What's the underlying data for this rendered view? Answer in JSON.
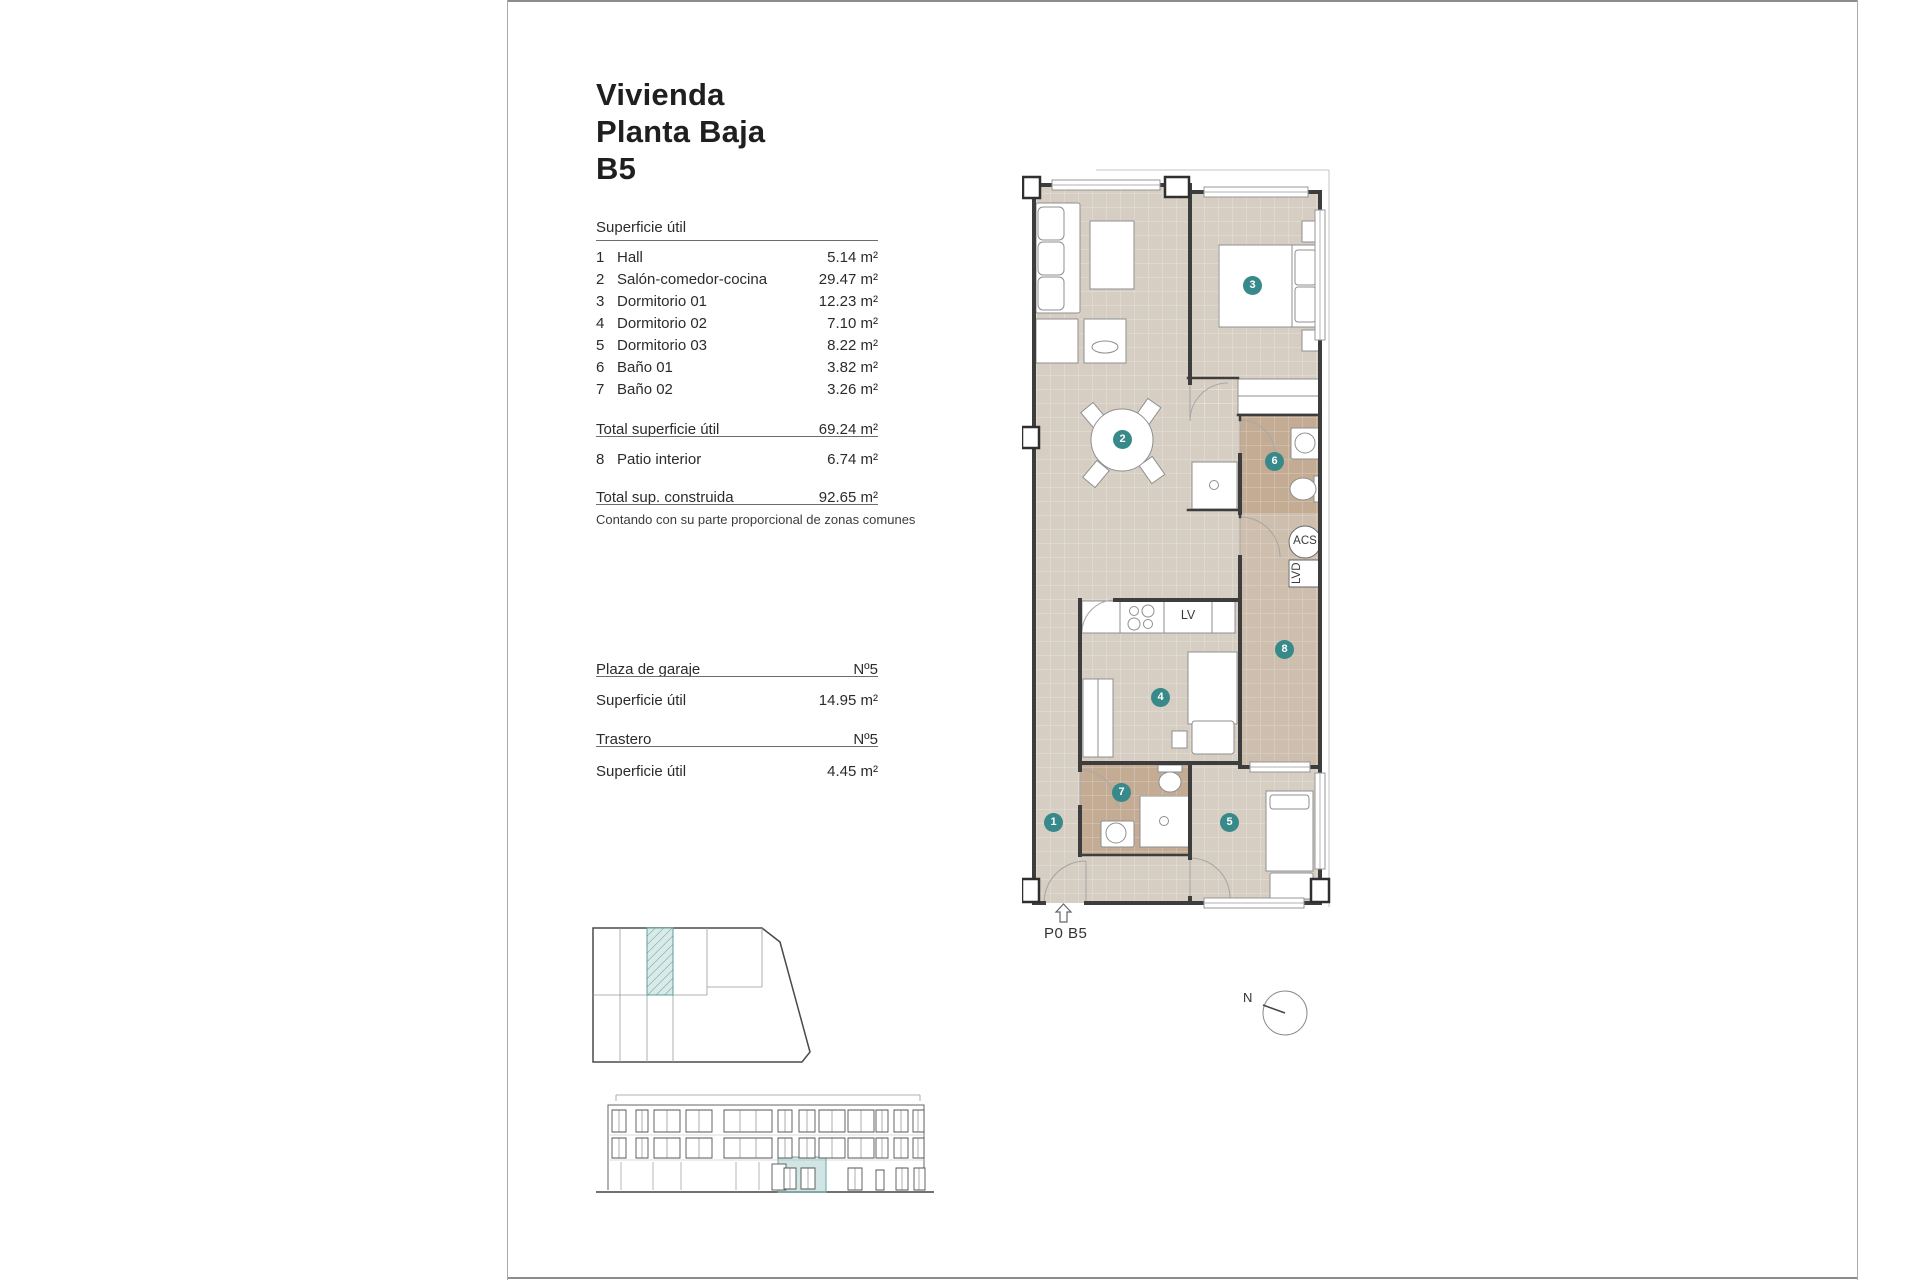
{
  "page": {
    "title_lines": [
      "Vivienda",
      "Planta Baja",
      "B5"
    ]
  },
  "surface_section": {
    "header": "Superficie útil",
    "rows": [
      {
        "num": "1",
        "name": "Hall",
        "area": "5.14 m²"
      },
      {
        "num": "2",
        "name": "Salón-comedor-cocina",
        "area": "29.47 m²"
      },
      {
        "num": "3",
        "name": "Dormitorio 01",
        "area": "12.23 m²"
      },
      {
        "num": "4",
        "name": "Dormitorio 02",
        "area": "7.10 m²"
      },
      {
        "num": "5",
        "name": "Dormitorio 03",
        "area": "8.22 m²"
      },
      {
        "num": "6",
        "name": "Baño 01",
        "area": "3.82 m²"
      },
      {
        "num": "7",
        "name": "Baño 02",
        "area": "3.26 m²"
      }
    ],
    "total_label": "Total superficie útil",
    "total_value": "69.24 m²",
    "patio_row": {
      "num": "8",
      "name": "Patio interior",
      "area": "6.74 m²"
    },
    "constructed_label": "Total sup. construida",
    "constructed_value": "92.65 m²",
    "note": "Contando con su parte proporcional de zonas comunes"
  },
  "garage": {
    "label": "Plaza de garaje",
    "number": "Nº5",
    "area_label": "Superficie útil",
    "area_value": "14.95 m²"
  },
  "storage": {
    "label": "Trastero",
    "number": "Nº5",
    "area_label": "Superficie útil",
    "area_value": "4.45 m²"
  },
  "floor_plan": {
    "rooms": [
      {
        "num": "1"
      },
      {
        "num": "2"
      },
      {
        "num": "3"
      },
      {
        "num": "4"
      },
      {
        "num": "5"
      },
      {
        "num": "6"
      },
      {
        "num": "7"
      },
      {
        "num": "8"
      }
    ],
    "labels": {
      "dishwasher": "LV",
      "water_heater": "ACS",
      "washer": "LVD"
    },
    "plan_code": "P0 B5"
  },
  "north": {
    "label": "N"
  },
  "colors": {
    "accent_teal": "#38898a",
    "floor_main": "#d7cec3",
    "floor_wet": "#c3ab94",
    "floor_patio": "#cdbead",
    "highlight_fill": "#d9eae8",
    "wall": "#3d3d3d"
  }
}
